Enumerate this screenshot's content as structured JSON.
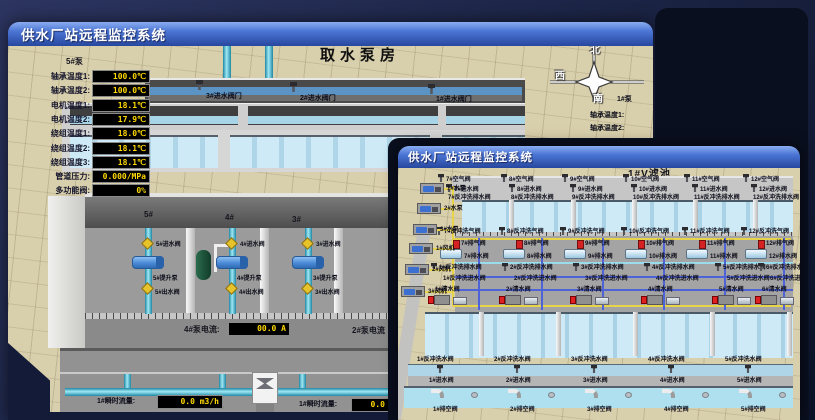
{
  "app": {
    "colors": {
      "titlebar_blue": "#4a74d4",
      "lcd_text_yellow": "#ffd900",
      "ground_tan": "#d8cfac",
      "water_blue": "#bfe2f0",
      "pipe_cyan": "#35a8c0",
      "valve_yellow": "#e7c32b",
      "alarm_red": "#d42222"
    }
  },
  "back": {
    "title": "供水厂站远程监控系统",
    "scene_title": "取水泵房",
    "inlet_valves": [
      "3#进水阀门",
      "2#进水阀门",
      "1#进水阀门"
    ],
    "pump_panel": {
      "title": "5#泵",
      "rows": [
        {
          "label": "轴承温度1:",
          "value": "100.0℃"
        },
        {
          "label": "轴承温度2:",
          "value": "100.0℃"
        },
        {
          "label": "电机温度1:",
          "value": "18.1℃"
        },
        {
          "label": "电机温度2:",
          "value": "17.9℃"
        },
        {
          "label": "绕组温度1:",
          "value": "18.0℃"
        },
        {
          "label": "绕组温度2:",
          "value": "18.1℃"
        },
        {
          "label": "绕组温度3:",
          "value": "18.1℃"
        },
        {
          "label": "管道压力:",
          "value": "0.000/MPa"
        },
        {
          "label": "多功能阀:",
          "value": "0%"
        }
      ]
    },
    "compass": {
      "north": "北",
      "west": "西",
      "south": "南"
    },
    "right_panel": {
      "pump": "1#泵",
      "rows": [
        "轴承温度1:",
        "轴承温度2:"
      ]
    },
    "bays": [
      "5#",
      "4#",
      "3#"
    ],
    "pump_units": [
      {
        "inlet": "5#进水阀",
        "pump": "5#提升泵",
        "outlet": "5#出水阀"
      },
      {
        "inlet": "4#进水阀",
        "pump": "4#提升泵",
        "outlet": "4#出水阀"
      },
      {
        "inlet": "3#进水阀",
        "pump": "3#提升泵",
        "outlet": "3#出水阀"
      }
    ],
    "current": {
      "label": "4#泵电流:",
      "value": "00.0 A",
      "label2": "2#泵电流"
    },
    "flow": [
      {
        "label": "1#瞬时流量:",
        "value": "0.0 m3/h"
      },
      {
        "label": "1#瞬时流量:",
        "value": "0.0 m3/h"
      }
    ]
  },
  "front": {
    "title": "供水厂站远程监控系统",
    "scene_title": "1#V滤池",
    "top_air": [
      "7#空气阀",
      "8#空气阀",
      "9#空气阀",
      "10#空气阀",
      "11#空气阀",
      "12#空气阀"
    ],
    "top_inlet": [
      "7#进水阀",
      "8#进水阀",
      "9#进水阀",
      "10#进水阀",
      "11#进水阀",
      "12#进水阀"
    ],
    "top_bw_drain": [
      "7#反冲洗排水阀",
      "8#反冲洗排水阀",
      "9#反冲洗排水阀",
      "10#反冲洗排水阀",
      "11#反冲洗排水阀",
      "12#反冲洗排水阀"
    ],
    "mid_bw_air": [
      "7#反冲洗气阀",
      "8#反冲洗气阀",
      "9#反冲洗气阀",
      "10#反冲洗气阀",
      "11#反冲洗气阀",
      "12#反冲洗气阀"
    ],
    "mid_vent": [
      "7#排气阀",
      "8#排气阀",
      "9#排气阀",
      "10#排气阀",
      "11#排气阀",
      "12#排气阀"
    ],
    "mid_drain": [
      "7#排水阀",
      "8#排水阀",
      "9#排水阀",
      "10#排水阀",
      "11#排水阀",
      "12#排水阀"
    ],
    "mid_low_bw_drain": [
      "1#反冲洗排水阀",
      "2#反冲洗排水阀",
      "3#反冲洗排水阀",
      "4#反冲洗排水阀",
      "5#反冲洗排水阀",
      "6#反冲洗排水阀"
    ],
    "mid_low_bw_inlet": [
      "1#反冲洗进水阀",
      "2#反冲洗进水阀",
      "3#反冲洗进水阀",
      "4#反冲洗进水阀",
      "5#反冲洗进水阀",
      "6#反冲洗进水阀"
    ],
    "mid_low_clean": [
      "1#清水阀",
      "2#清水阀",
      "3#清水阀",
      "4#清水阀",
      "5#清水阀",
      "6#清水阀"
    ],
    "bot_bw_water": [
      "1#反冲洗水阀",
      "2#反冲洗水阀",
      "3#反冲洗水阀",
      "4#反冲洗水阀",
      "5#反冲洗水阀"
    ],
    "bot_inlet": [
      "1#进水阀",
      "2#进水阀",
      "3#进水阀",
      "4#进水阀",
      "5#进水阀"
    ],
    "bot_empty": [
      "1#排空阀",
      "2#排空阀",
      "3#排空阀",
      "4#排空阀",
      "5#排空阀"
    ],
    "equipment": [
      "1#水泵",
      "2#水泵",
      "3#水泵",
      "1#风机",
      "2#风机",
      "3#风机"
    ]
  }
}
